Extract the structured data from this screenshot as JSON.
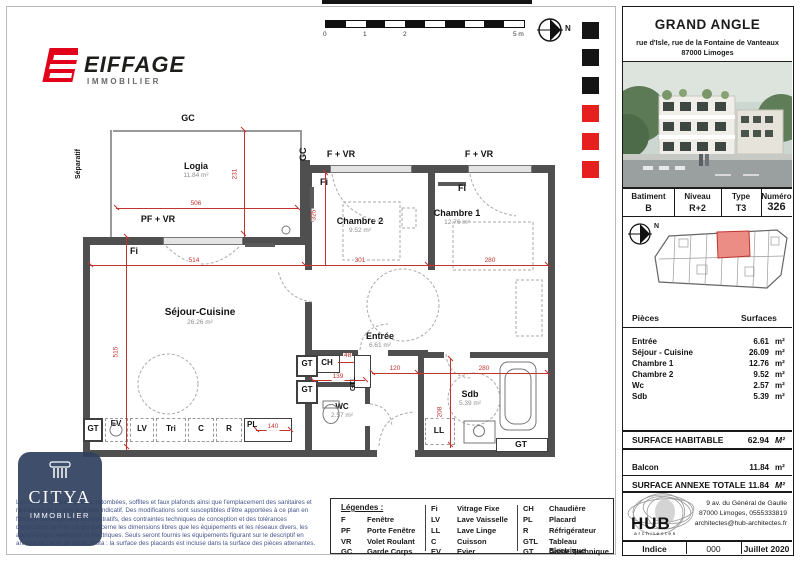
{
  "brand": {
    "name": "EIFFAGE",
    "division": "IMMOBILIER"
  },
  "scalebar": {
    "t0": "0",
    "t1": "1",
    "t2": "2",
    "t5": "5 m"
  },
  "north_label": "N",
  "plan": {
    "labels": {
      "gc": "GC",
      "separatif": "Séparatif",
      "pf_vr": "PF + VR",
      "f_vr": "F + VR",
      "fi": "Fi",
      "gt": "GT",
      "gtl": "GTL",
      "ch": "CH",
      "ev": "EV",
      "lv": "LV",
      "tri": "Tri",
      "c": "C",
      "r": "R",
      "pl": "PL",
      "ll": "LL"
    },
    "rooms": {
      "logia": {
        "name": "Logia",
        "area": "11.84 m²"
      },
      "sejour": {
        "name": "Séjour-Cuisine",
        "area": "26.26 m²"
      },
      "chambre1": {
        "name": "Chambre 1",
        "area": "12.76 m²"
      },
      "chambre2": {
        "name": "Chambre 2",
        "area": "9.52 m²"
      },
      "entree": {
        "name": "Entrée",
        "area": "6.61 m²"
      },
      "wc": {
        "name": "WC",
        "area": "2.57 m²"
      },
      "sdb": {
        "name": "Sdb",
        "area": "5.39 m²"
      }
    },
    "dims": {
      "d506": "506",
      "d231": "231",
      "d514": "514",
      "d515": "515",
      "d301": "301",
      "d280a": "280",
      "d325": "325",
      "d48": "48",
      "d139": "139",
      "d120": "120",
      "d280b": "280",
      "d208": "208",
      "d140": "140"
    }
  },
  "legend": {
    "title": "Légendes :",
    "columns": [
      {
        "rows": [
          {
            "abbr": "F",
            "label": "Fenêtre"
          },
          {
            "abbr": "PF",
            "label": "Porte Fenêtre"
          },
          {
            "abbr": "VR",
            "label": "Volet Roulant"
          },
          {
            "abbr": "GC",
            "label": "Garde Corps"
          }
        ]
      },
      {
        "rows": [
          {
            "abbr": "Fi",
            "label": "Vitrage Fixe"
          },
          {
            "abbr": "LV",
            "label": "Lave Vaisselle"
          },
          {
            "abbr": "LL",
            "label": "Lave Linge"
          },
          {
            "abbr": "C",
            "label": "Cuisson"
          },
          {
            "abbr": "EV",
            "label": "Evier"
          }
        ]
      },
      {
        "rows": [
          {
            "abbr": "CH",
            "label": "Chaudière"
          },
          {
            "abbr": "PL",
            "label": "Placard"
          },
          {
            "abbr": "R",
            "label": "Réfrigérateur"
          },
          {
            "abbr": "GTL",
            "label": "Tableau Electrique"
          },
          {
            "abbr": "GT",
            "label": "Gaine Technique"
          }
        ]
      }
    ]
  },
  "side": {
    "title": "GRAND ANGLE",
    "address1": "rue d'Isle, rue de la Fontaine de Vanteaux",
    "address2": "87000 Limoges",
    "unit": {
      "h1": "Batiment",
      "h2": "Niveau",
      "h3": "Type",
      "h4": "Numéro",
      "v1": "B",
      "v2": "R+2",
      "v3": "T3",
      "v4": "326"
    },
    "surfaces": {
      "head_left": "Pièces",
      "head_right": "Surfaces",
      "rows": [
        {
          "label": "Entrée",
          "value": "6.61",
          "unit": "m²"
        },
        {
          "label": "Séjour - Cuisine",
          "value": "26.09",
          "unit": "m²"
        },
        {
          "label": "Chambre 1",
          "value": "12.76",
          "unit": "m²"
        },
        {
          "label": "Chambre 2",
          "value": "9.52",
          "unit": "m²"
        },
        {
          "label": "Wc",
          "value": "2.57",
          "unit": "m²"
        },
        {
          "label": "Sdb",
          "value": "5.39",
          "unit": "m²"
        }
      ]
    },
    "habitable": {
      "label": "SURFACE HABITABLE",
      "value": "62.94",
      "unit": "M²"
    },
    "balcon": {
      "label": "Balcon",
      "value": "11.84",
      "unit": "m²"
    },
    "annexe": {
      "label": "SURFACE ANNEXE TOTALE",
      "value": "11.84",
      "unit": "M²"
    },
    "architect": {
      "name": "HUB",
      "sub": "architectes",
      "line1": "9 av. du Général de Gaulle",
      "line2": "87000 Limoges, 0555333819",
      "line3": "architectes@hub-architectes.fr"
    },
    "revision": {
      "label": "Indice",
      "value": "000",
      "date": "Juillet 2020"
    }
  },
  "citya": {
    "name": "CITYA",
    "sub": "IMMOBILIER"
  },
  "legal": "Les surfaces, côtes, gaines, retombées, soffites et faux plafonds ainsi que l'emplacement des sanitaires et radiateurs ne le sont qu'à titre indicatif. Des modifications sont susceptibles d'être apportées à ce plan en fonction des impératifs administratifs, des contraintes techniques de conception et des tolérances d'exécution, tant en ce qui concerne les dimensions libres que les équipements et les réseaux divers, les appareillages sanitaires et électriques. Seuls seront fournis les équipements figurant sur le descriptif en annexe de l'acte de vente.      Nota : la surface des placards est incluse dans la surface des pièces attenantes."
}
